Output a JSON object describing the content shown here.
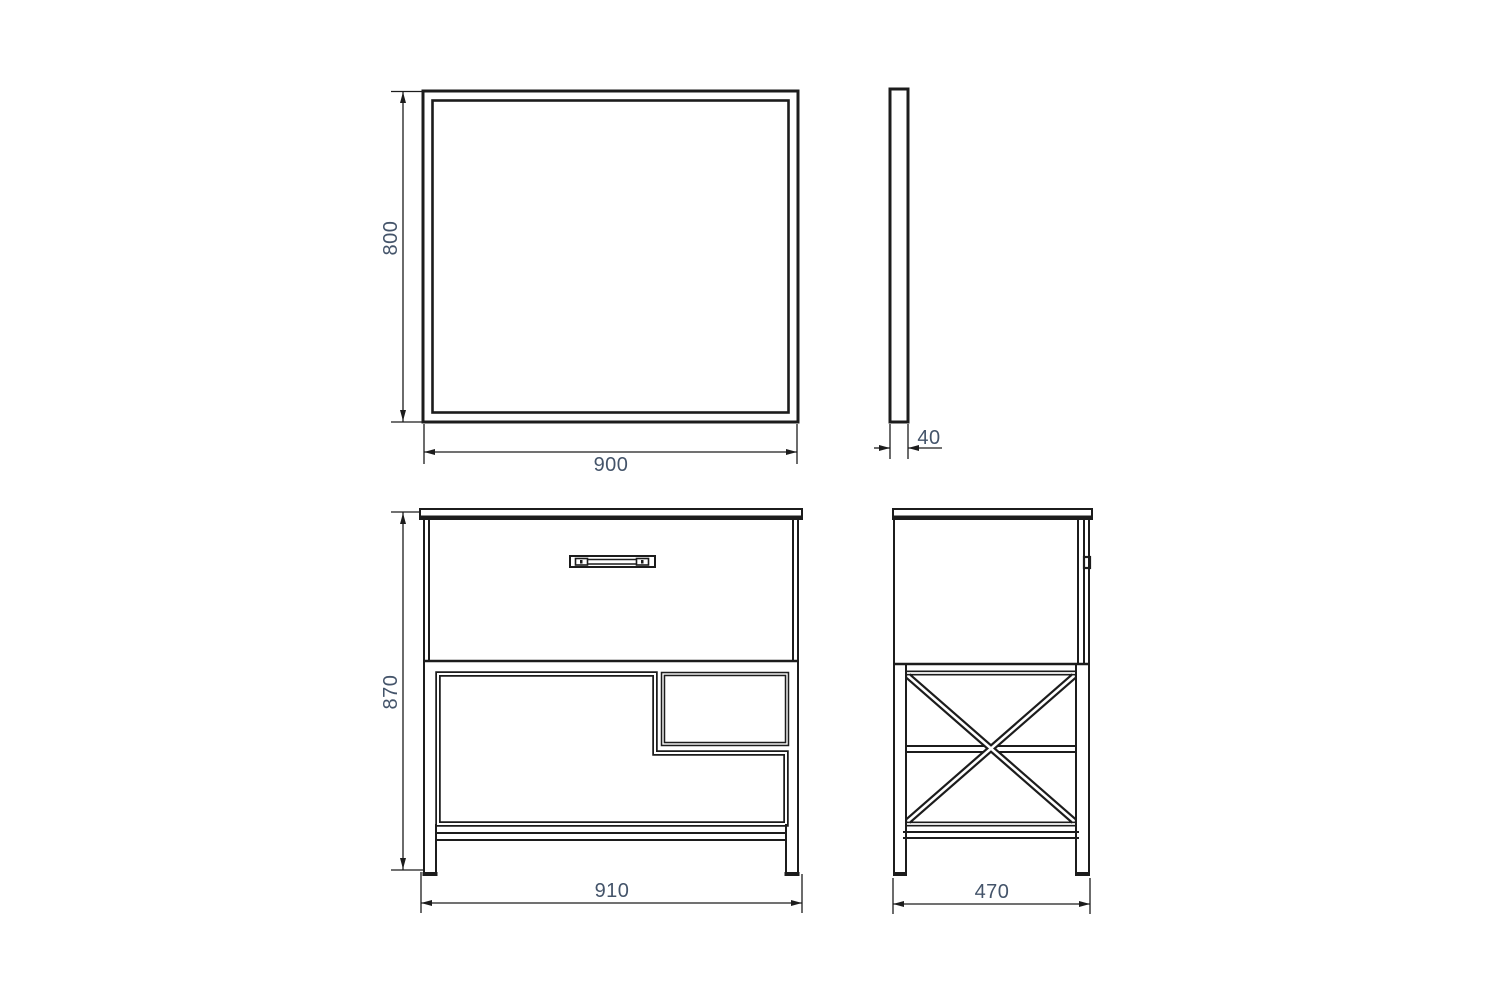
{
  "page": {
    "background": "#ffffff"
  },
  "drawing": {
    "kind": "orthographic technical drawing",
    "line_color": "#1c1c1c",
    "dim_text_color": "#44546a",
    "views": {
      "mirror_front": {
        "height_dim": "800",
        "width_dim": "900"
      },
      "mirror_side": {
        "thickness_dim": "40"
      },
      "cabinet_front": {
        "height_dim": "870",
        "width_dim": "910"
      },
      "cabinet_side": {
        "depth_dim": "470"
      }
    }
  }
}
